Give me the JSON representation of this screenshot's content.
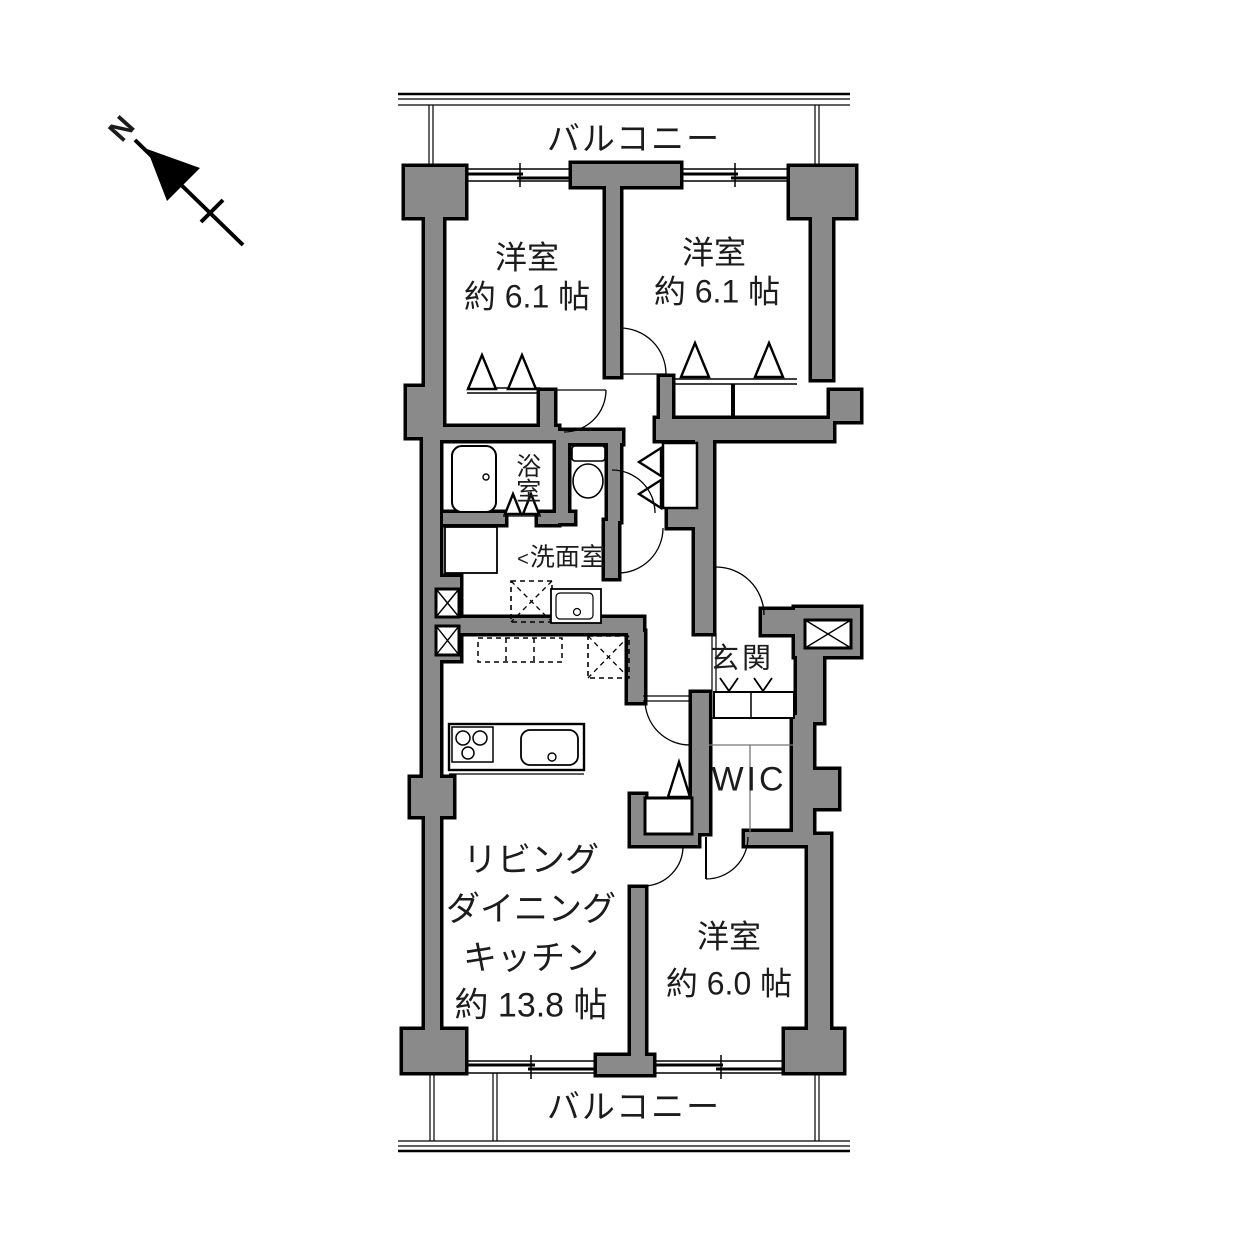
{
  "compass": {
    "north": "N"
  },
  "balcony_top": {
    "label": "バルコニー"
  },
  "balcony_bottom": {
    "label": "バルコニー"
  },
  "rooms": {
    "bedroom_top_left": {
      "name": "洋室",
      "size": "約 6.1 帖"
    },
    "bedroom_top_right": {
      "name": "洋室",
      "size": "約 6.1 帖"
    },
    "bedroom_bottom": {
      "name": "洋室",
      "size": "約 6.0 帖"
    },
    "ldk": {
      "line1": "リビング",
      "line2": "ダイニング",
      "line3": "キッチン",
      "size": "約 13.8 帖"
    },
    "bath": {
      "name": "浴室"
    },
    "washroom": {
      "name": "洗面室",
      "pointer": "<"
    },
    "entrance": {
      "name": "玄関"
    },
    "walk_in_closet": {
      "name": "WIC"
    }
  },
  "colors": {
    "wall": "#8a8a8a",
    "line": "#000000",
    "text": "#1c1c1c",
    "bg": "#ffffff"
  }
}
